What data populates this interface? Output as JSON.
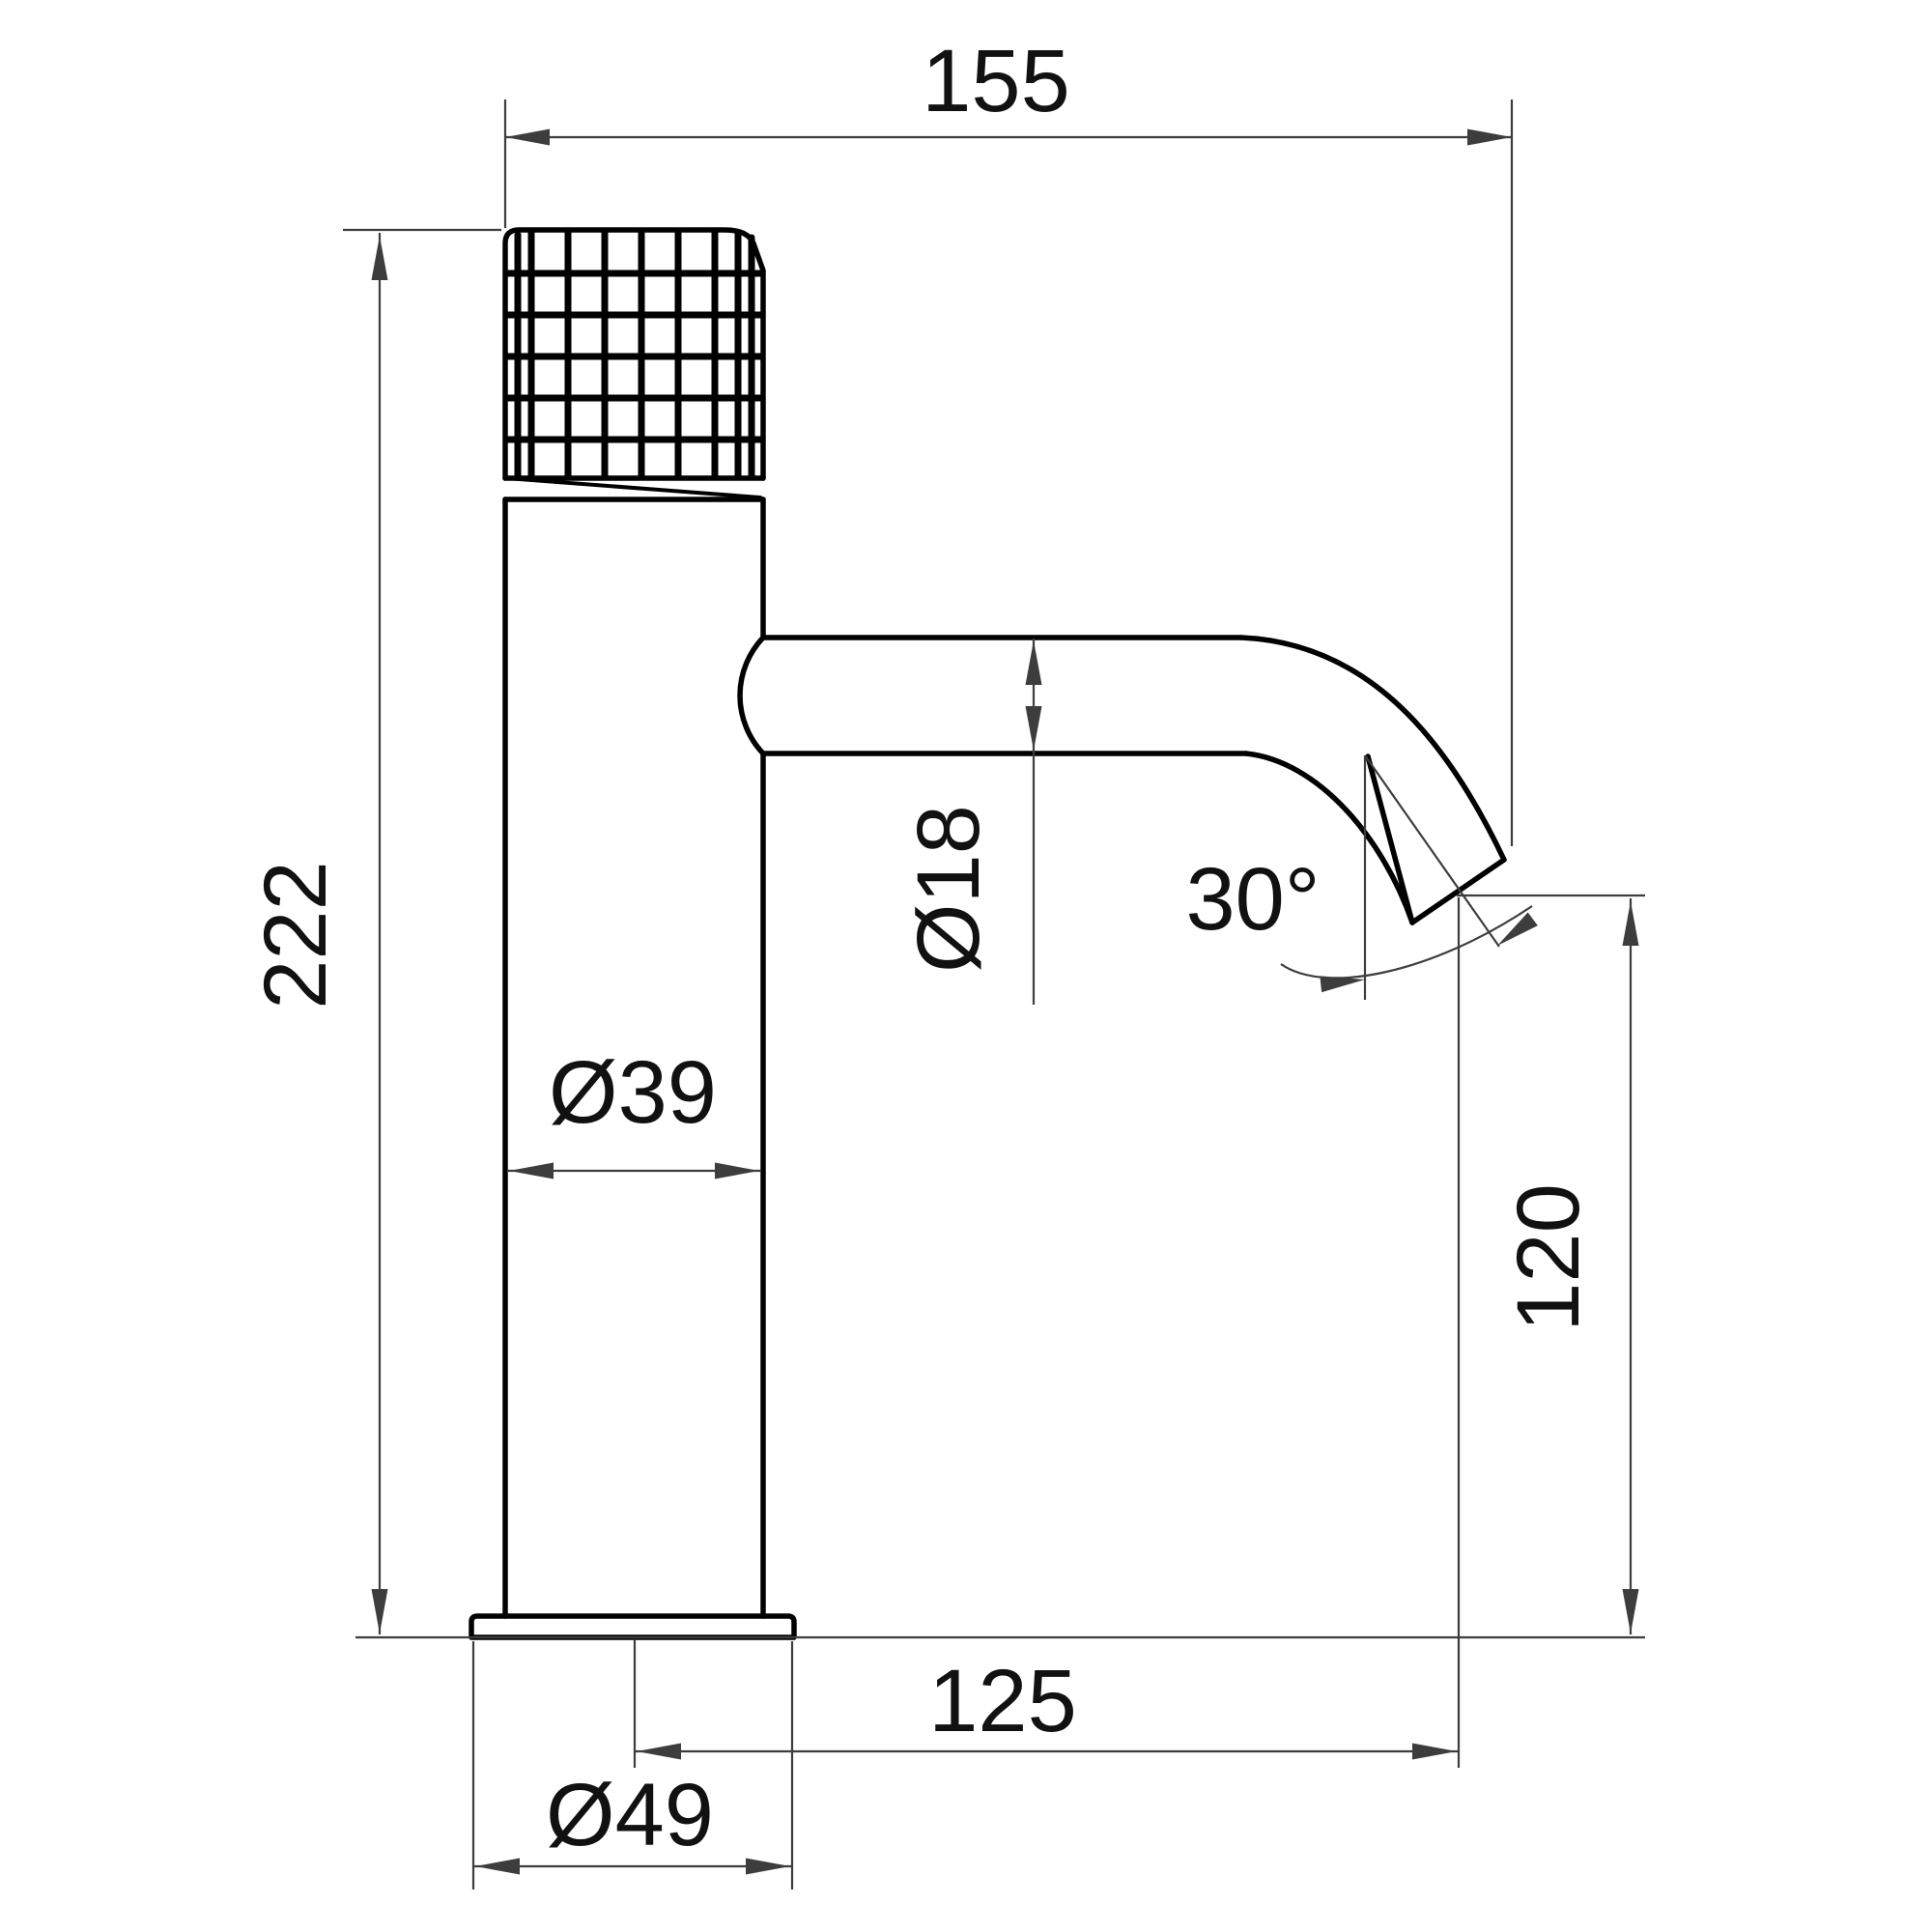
{
  "drawing": {
    "type": "technical-dimension-drawing",
    "subject": "single-lever basin faucet side view",
    "labels": {
      "spout_reach_top": "155",
      "total_height": "222",
      "spout_tube_diameter": "Ø18",
      "spout_angle": "30°",
      "body_diameter": "Ø39",
      "outlet_height": "120",
      "outlet_offset": "125",
      "base_diameter": "Ø49"
    },
    "colors": {
      "outline": "#000000",
      "dimension_lines": "#3d3d3d",
      "text": "#111111",
      "background": "#ffffff"
    }
  }
}
